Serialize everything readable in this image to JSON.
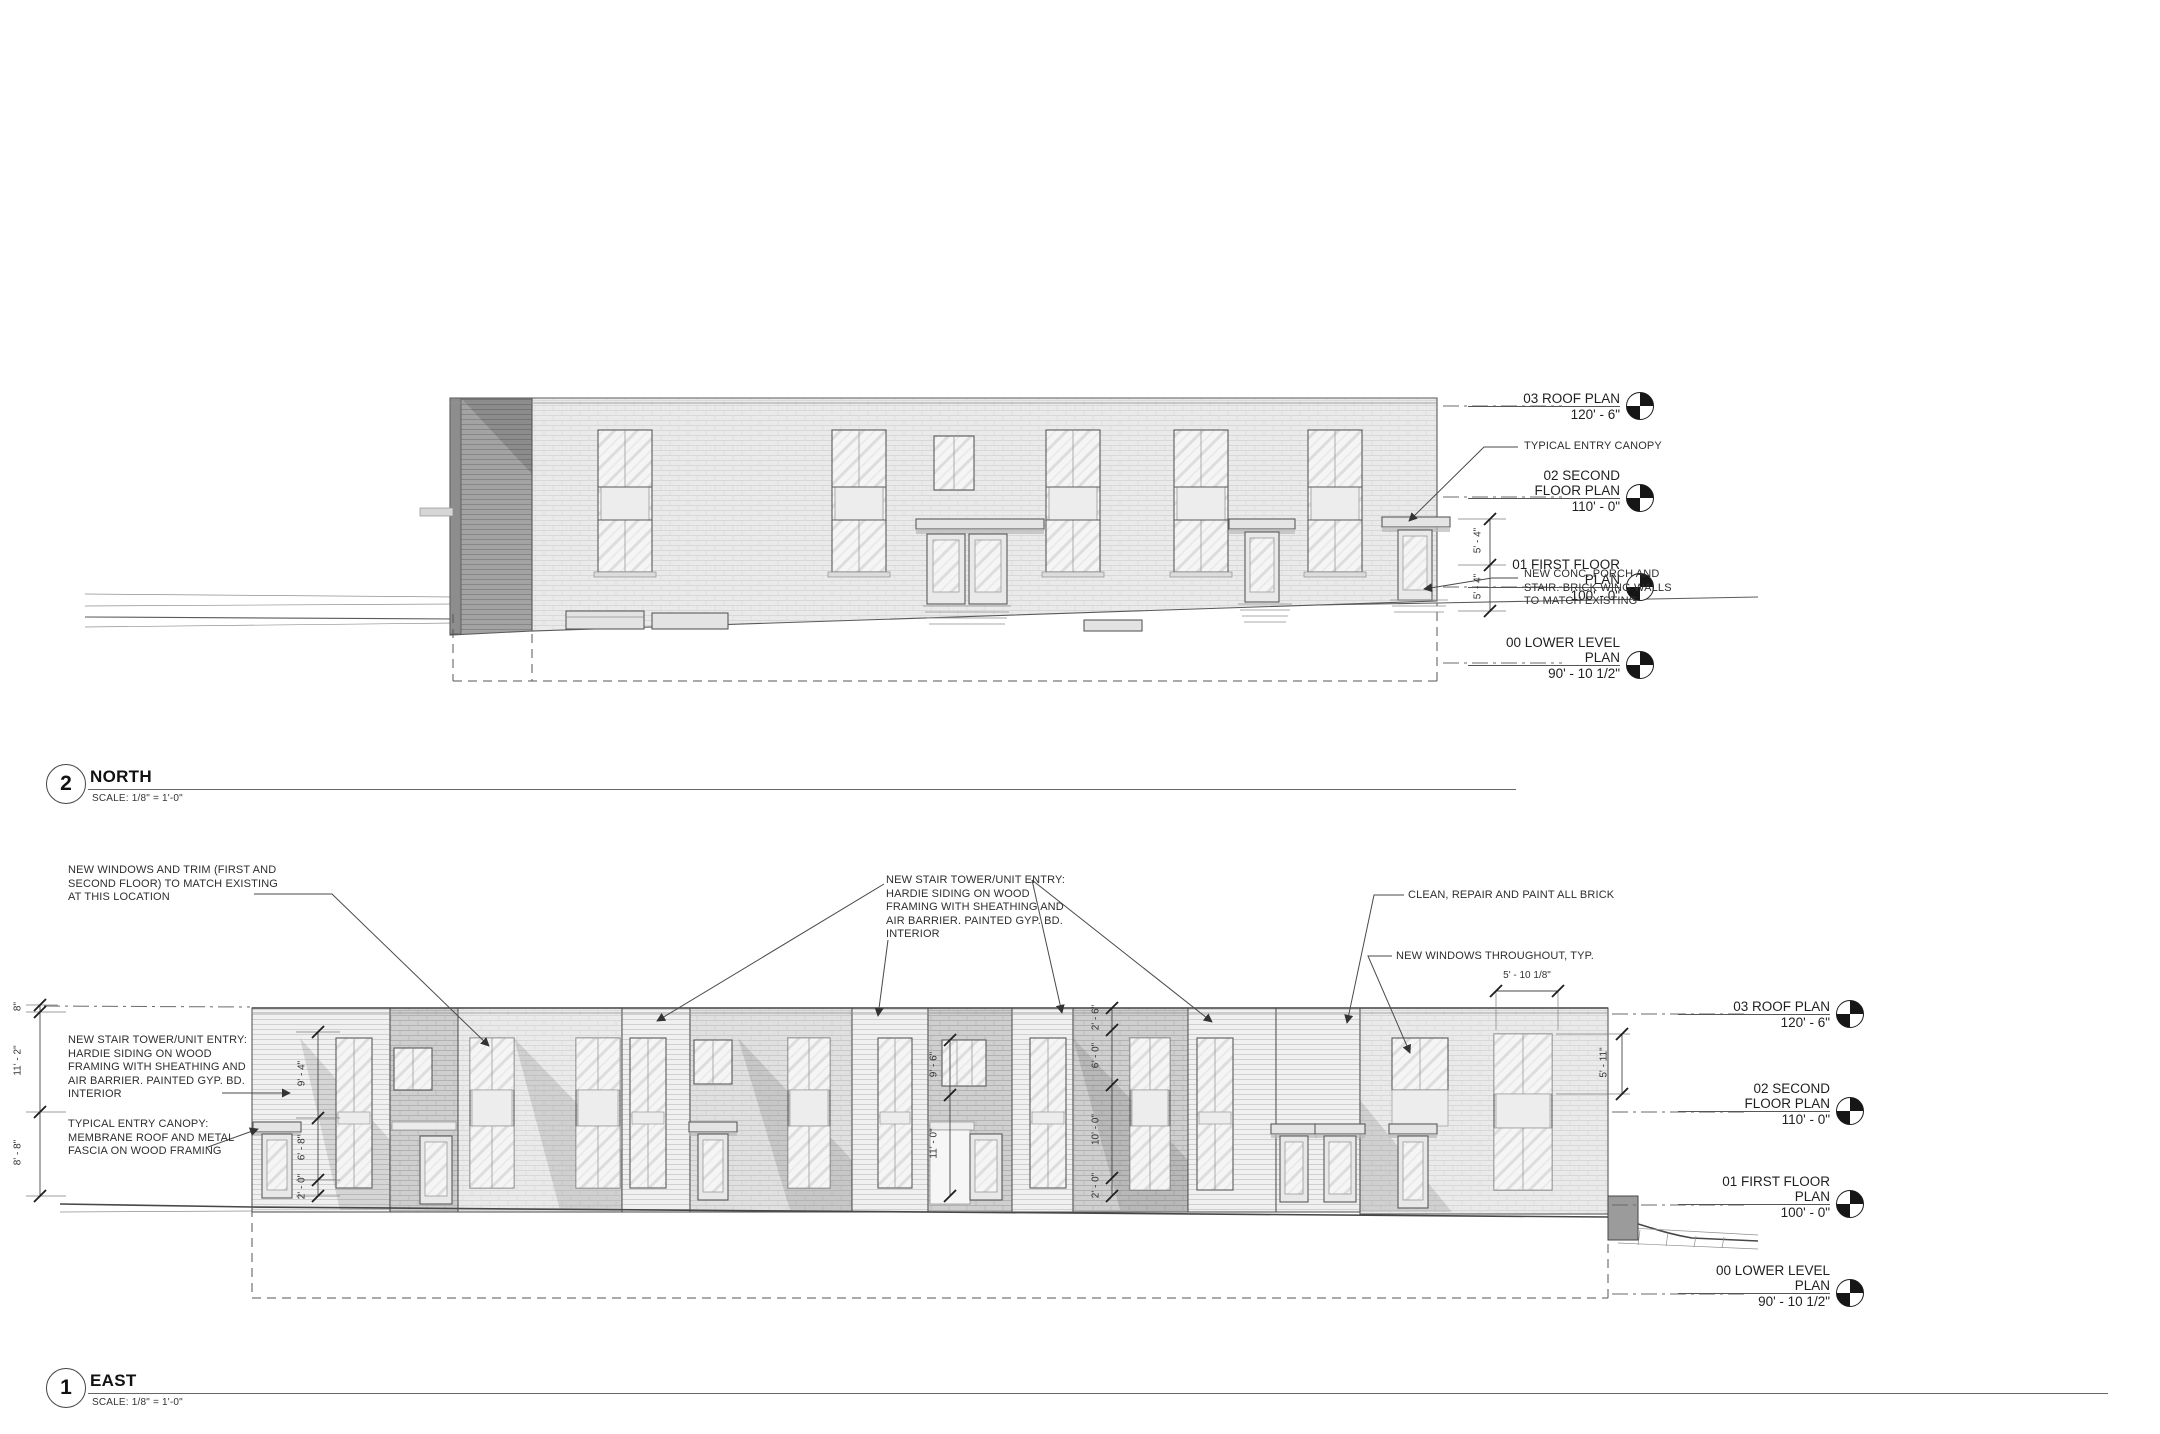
{
  "north_view": {
    "number": "2",
    "title": "NORTH",
    "scale": "SCALE:  1/8\" = 1'-0\"",
    "levels": [
      {
        "line1": "03 ROOF PLAN",
        "line2": "",
        "elev": "120' - 6\""
      },
      {
        "line1": "02 SECOND",
        "line2": "FLOOR PLAN",
        "elev": "110' - 0\""
      },
      {
        "line1": "01 FIRST FLOOR",
        "line2": "PLAN",
        "elev": "100' - 0\""
      },
      {
        "line1": "00 LOWER LEVEL",
        "line2": "PLAN",
        "elev": "90' - 10 1/2\""
      }
    ],
    "notes": {
      "entry_canopy": "TYPICAL ENTRY CANOPY",
      "conc_porch": "NEW CONC. PORCH AND\nSTAIR. BRICK WING WALLS\nTO MATCH EXISTING"
    },
    "dims": {
      "porch_upper": "5' - 4\"",
      "porch_lower": "5' - 4\""
    }
  },
  "east_view": {
    "number": "1",
    "title": "EAST",
    "scale": "SCALE:  1/8\" = 1'-0\"",
    "levels": [
      {
        "line1": "03 ROOF PLAN",
        "line2": "",
        "elev": "120' - 6\""
      },
      {
        "line1": "02 SECOND",
        "line2": "FLOOR PLAN",
        "elev": "110' - 0\""
      },
      {
        "line1": "01 FIRST FLOOR",
        "line2": "PLAN",
        "elev": "100' - 0\""
      },
      {
        "line1": "00 LOWER LEVEL",
        "line2": "PLAN",
        "elev": "90' - 10 1/2\""
      }
    ],
    "notes": {
      "windows_trim": "NEW WINDOWS AND TRIM (FIRST AND\nSECOND FLOOR) TO MATCH EXISTING\nAT THIS LOCATION",
      "stair_tower_left": "NEW STAIR TOWER/UNIT ENTRY:\nHARDIE SIDING ON WOOD\nFRAMING WITH SHEATHING AND\nAIR BARRIER.  PAINTED GYP. BD.\nINTERIOR",
      "entry_canopy_left": "TYPICAL ENTRY CANOPY:\nMEMBRANE ROOF AND METAL\nFASCIA ON WOOD FRAMING",
      "stair_tower_mid": "NEW STAIR TOWER/UNIT ENTRY:\nHARDIE SIDING ON WOOD\nFRAMING WITH SHEATHING AND\nAIR BARRIER.  PAINTED GYP. BD.\nINTERIOR",
      "clean_brick": "CLEAN, REPAIR AND PAINT ALL BRICK",
      "new_windows": "NEW WINDOWS THROUGHOUT, TYP."
    },
    "dims": {
      "left_chain": [
        "8\"",
        "11' - 2\"",
        "8' - 8\""
      ],
      "tower_chain": [
        "9' - 4\"",
        "6' - 8\"",
        "2' - 0\""
      ],
      "mid_left_chain": [
        "9' - 6\"",
        "11' - 0\""
      ],
      "mid_right_chain": [
        "2' - 6\"",
        "6' - 0\"",
        "10' - 0\"",
        "2' - 0\""
      ],
      "window_width": "5' - 10 1/8\"",
      "window_height": "5' - 11\""
    }
  }
}
